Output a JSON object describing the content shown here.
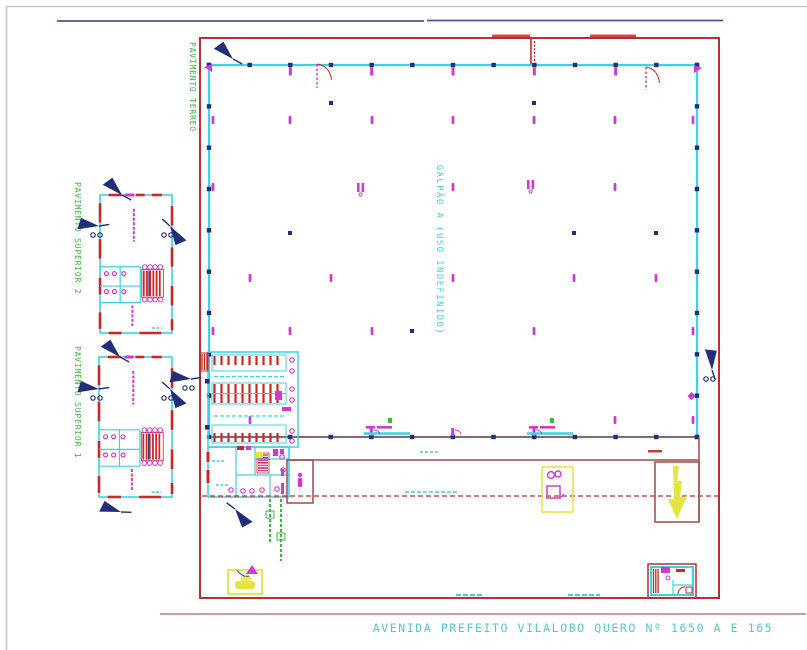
{
  "address_line": "AVENIDA PREFEITO VILALOBO QUERO Nº 1650 A E 165",
  "labels": {
    "building_a": "GALPÃO A (USO INDEFINIDO)",
    "ground_floor": "PAVIMENTO TERREO",
    "upper_floor_2": "PAVIMENTO SUPERIOR 2",
    "upper_floor_1": "PAVIMENTO SUPERIOR 1"
  },
  "colors": {
    "site_boundary_red": "#b83030",
    "band_red": "#a04848",
    "detail_red": "#cc2626",
    "wall_cyan": "#3dd2e2",
    "fixture_magenta": "#d03ad0",
    "label_green": "#3cb83c",
    "marker_navy": "#232e78",
    "reference_navy_line": "#54548c",
    "accent_yellow": "#e4e43c",
    "address_teal": "#54c8c8",
    "page_border_gray": "#c6c6c6"
  }
}
